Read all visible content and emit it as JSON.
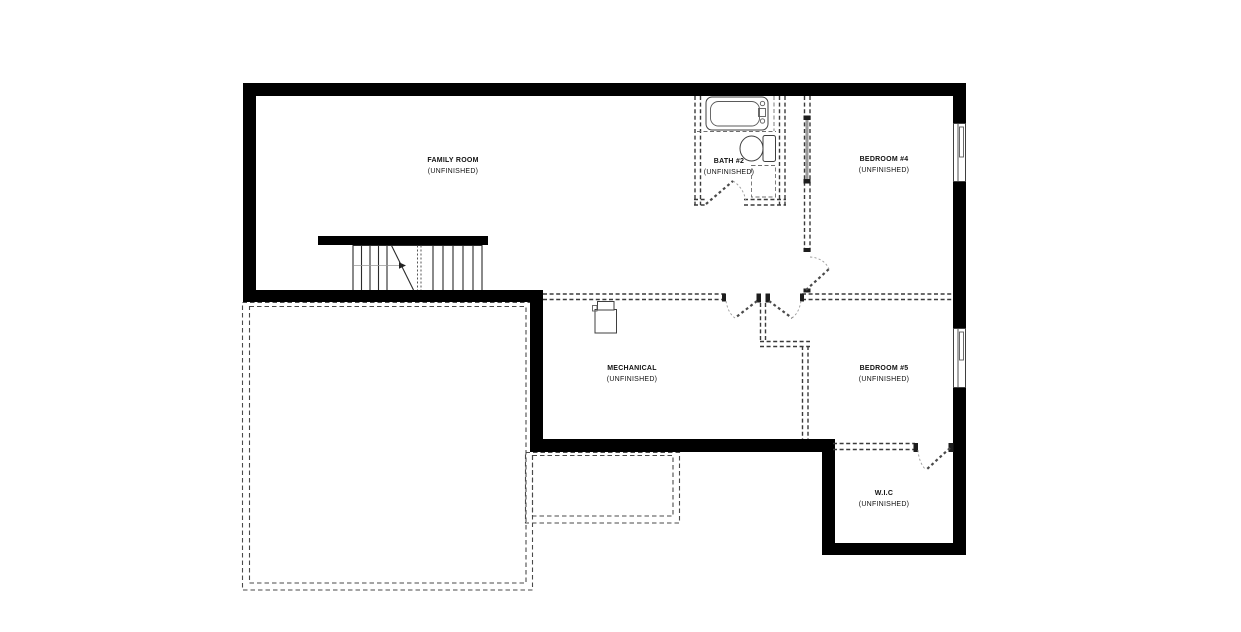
{
  "plan": {
    "title": "Basement Floor Plan",
    "rooms": [
      {
        "name": "FAMILY ROOM",
        "status": "(UNFINISHED)"
      },
      {
        "name": "BATH #2",
        "status": "(UNFINISHED)"
      },
      {
        "name": "BEDROOM #4",
        "status": "(UNFINISHED)"
      },
      {
        "name": "MECHANICAL",
        "status": "(UNFINISHED)"
      },
      {
        "name": "BEDROOM #5",
        "status": "(UNFINISHED)"
      },
      {
        "name": "W.I.C",
        "status": "(UNFINISHED)"
      }
    ],
    "fixtures": [
      "staircase",
      "bathtub",
      "toilet",
      "vanity",
      "furnace",
      "window",
      "window"
    ],
    "colors": {
      "wall": "#000000",
      "partition_dashed": "#3a3a3a",
      "door_panel": "#4a4a4a",
      "swing_arc": "#9a9a9a",
      "pocket_door": "#9a9a9a",
      "fixture_outline": "#3f3f3f",
      "background": "#ffffff"
    }
  }
}
